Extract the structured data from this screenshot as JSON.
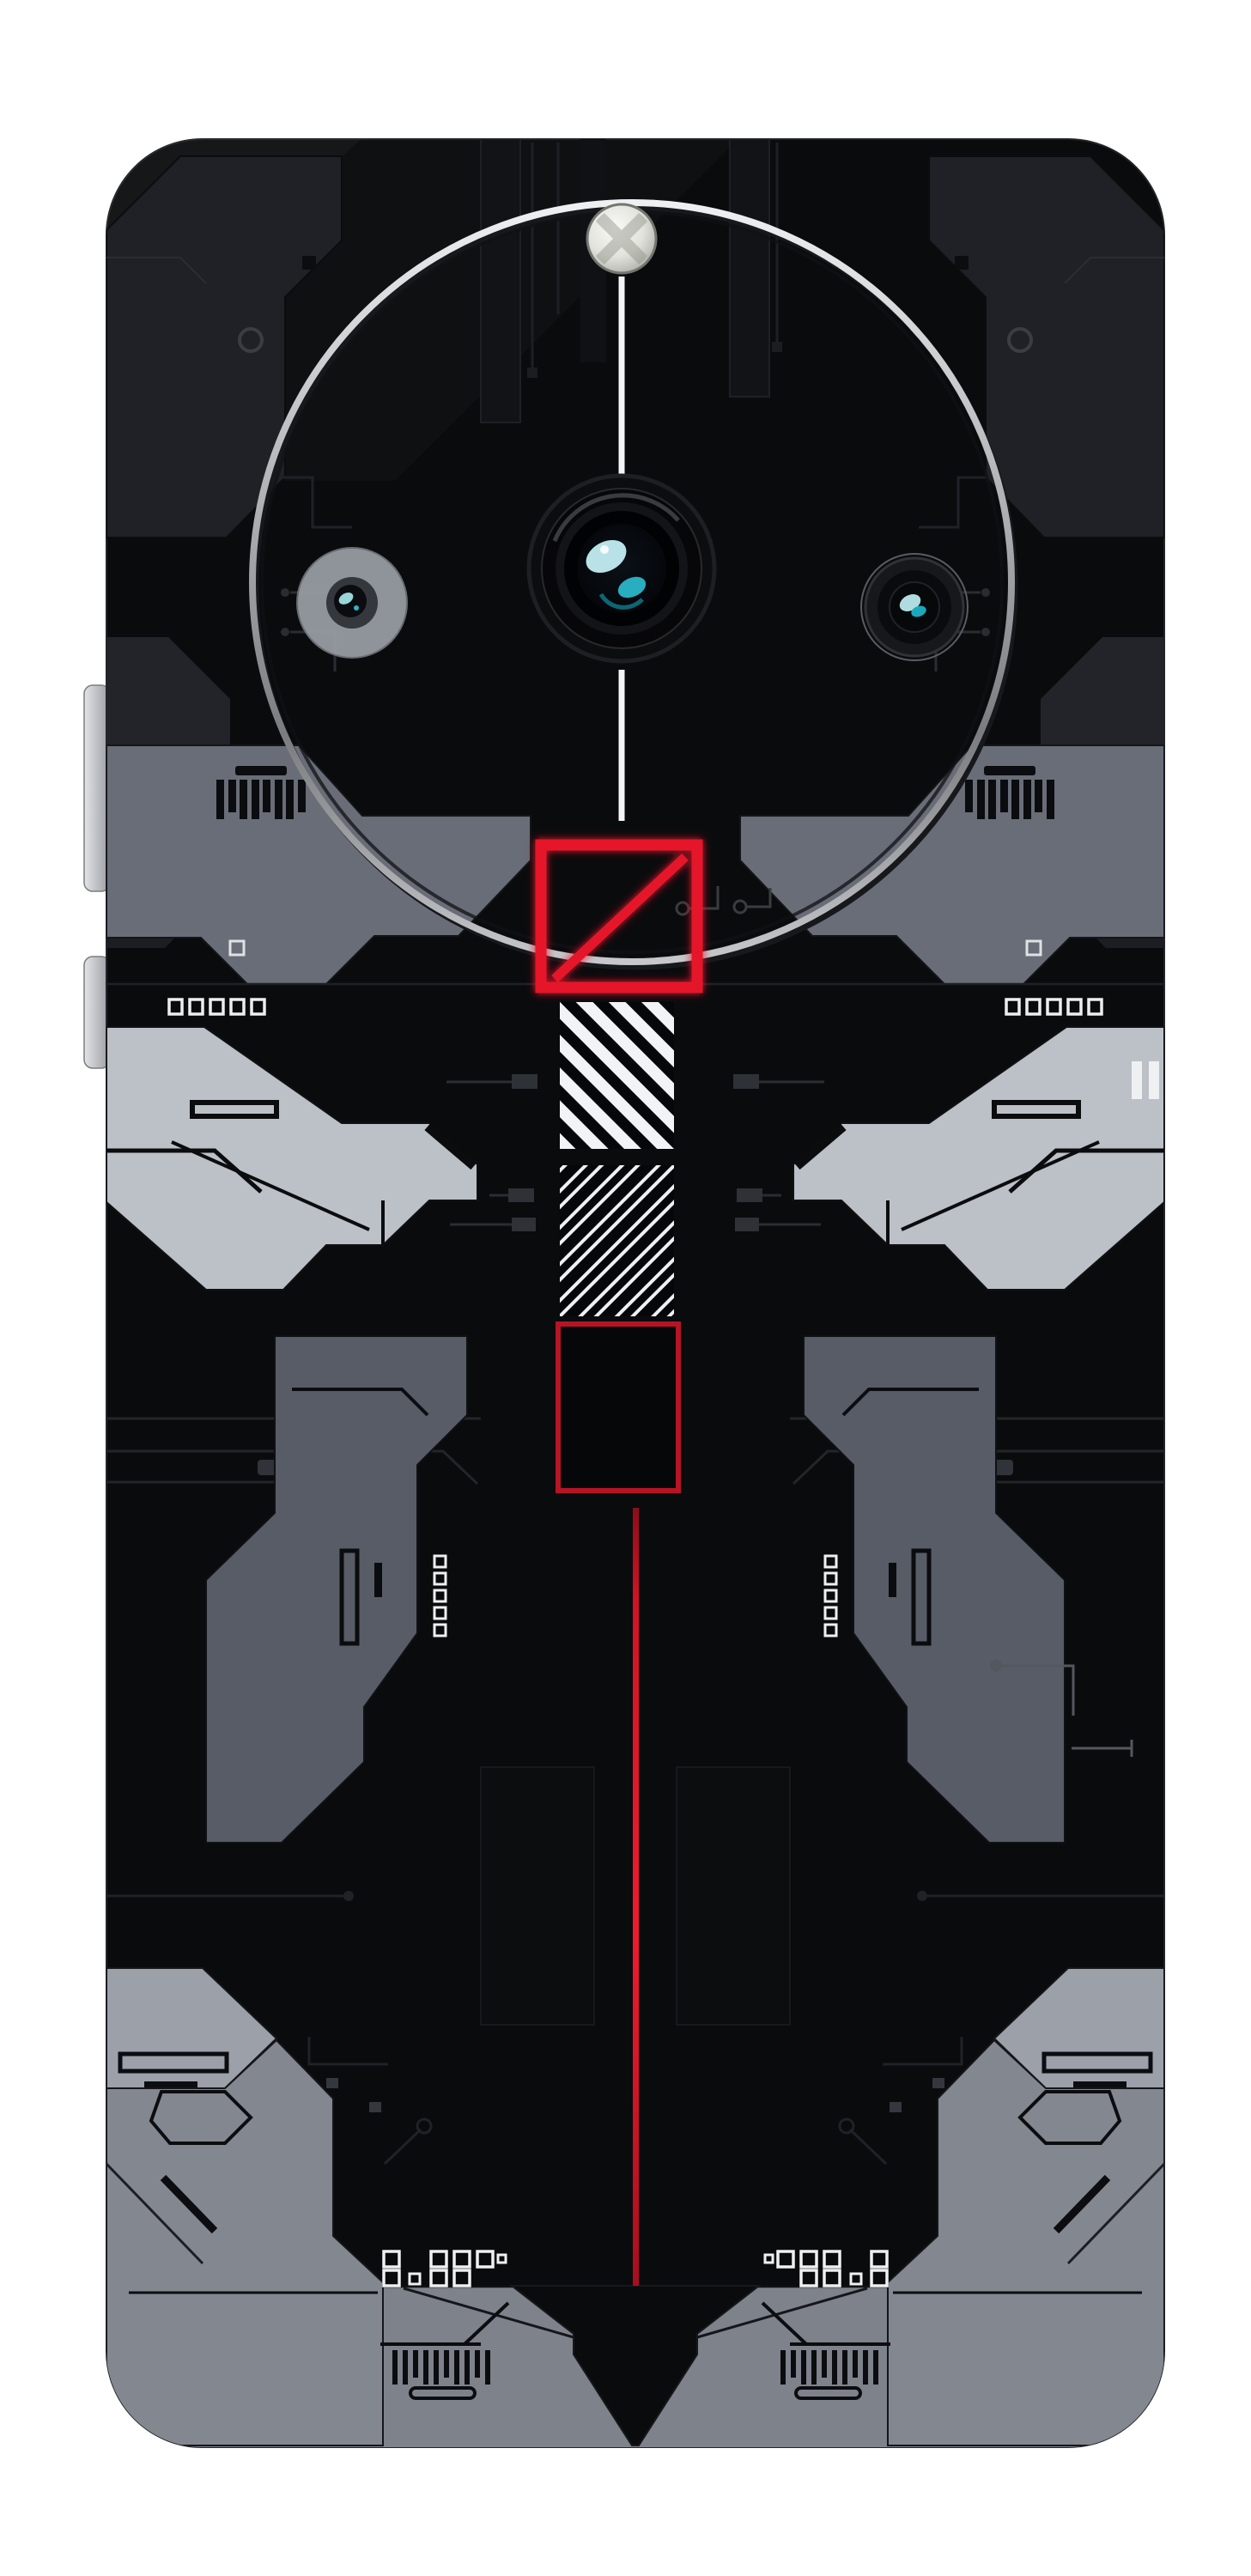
{
  "scene": {
    "background": "#ffffff",
    "subject": "black cyberpunk circuit-board phone back skin with circular camera module"
  },
  "colors": {
    "page_bg": "#ffffff",
    "body_black": "#0a0b0d",
    "panel_dark": "#1f2126",
    "shoulder_gray": "#686d77",
    "leg_gray": "#575c66",
    "plate_gray": "#83878f",
    "foot_gray": "#7e828b",
    "claw_light": "#bcc0c7",
    "corner_light": "#9ba0a9",
    "accent_red": "#e6192b",
    "deep_red": "#b61424",
    "line_white": "#f5f5f6",
    "lens_teal": "#2ab7c8",
    "ring_silver": "#c9cacd",
    "trace_gray": "#26282d",
    "button_gray": "#c7cad0"
  },
  "camera_module": {
    "ring": "thin silver circular ring",
    "flash": "led flash dot",
    "lenses": [
      "left-depth-lens",
      "main-lens",
      "right-telephoto-lens"
    ],
    "guide_line": "vertical white line through module"
  },
  "decorations": {
    "slash_square": {
      "style": "red outlined square with diagonal slash",
      "stroke": "#e6192b"
    },
    "hatch_box_solid": {
      "stripes": 6,
      "direction": "\\",
      "style": "solid white stripes on black"
    },
    "hatch_box_outline": {
      "stripes": 7,
      "direction": "/",
      "style": "outlined white stripes on black"
    },
    "empty_square": {
      "style": "red outlined rectangle",
      "stroke": "#b61424"
    },
    "red_line": {
      "style": "long vertical red line",
      "stroke": "#d41527"
    },
    "dip_switch_rows": {
      "left_squares": 5,
      "right_squares": 5
    },
    "barcode_blocks": {
      "top_left_bars": 8,
      "top_right_bars": 8,
      "bottom_left_bars": 10,
      "bottom_right_bars": 10
    },
    "bottom_dot_clusters": 2,
    "side_buttons": [
      "volume-rocker",
      "power-button"
    ]
  }
}
